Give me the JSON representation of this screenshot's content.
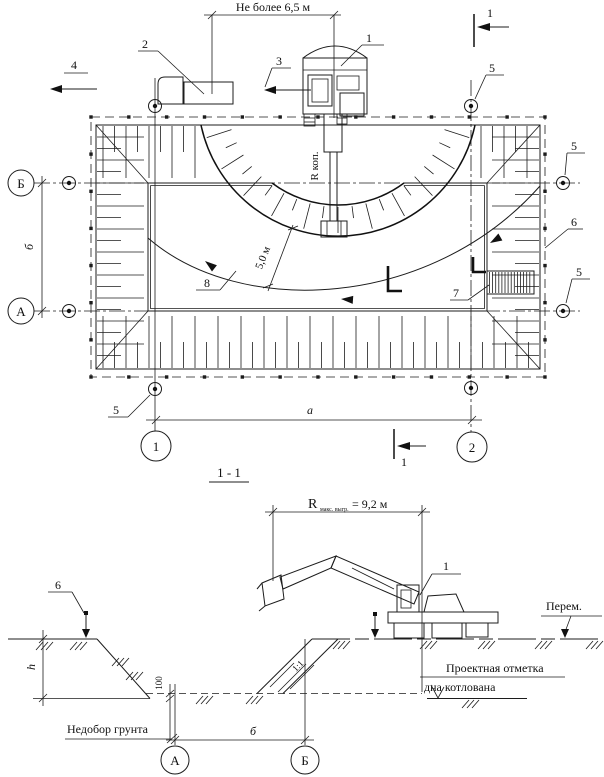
{
  "plan": {
    "top_dim": "Не более 6,5 м",
    "callout_1": "1",
    "callout_2": "2",
    "callout_3": "3",
    "callout_4": "4",
    "callout_5": "5",
    "callout_6": "6",
    "callout_7": "7",
    "callout_8": "8",
    "section_mark": "1",
    "axis_b": "Б",
    "axis_a": "А",
    "axis_1": "1",
    "axis_2": "2",
    "dim_a": "a",
    "dim_b": "б",
    "dig_radius": "R коп.",
    "arc_dim": "5,0 м"
  },
  "section": {
    "title": "1 - 1",
    "r_prefix": "R",
    "r_sub": "макс. выгр.",
    "r_value": "= 9,2 м",
    "callout_1": "1",
    "callout_6": "6",
    "move": "Перем.",
    "design_1": "Проектная отметка",
    "design_2": "дна котлована",
    "undercut": "Недобор грунта",
    "undercut_dim": "100",
    "h": "h",
    "slope": "1:1",
    "dim_b": "б",
    "axis_a": "А",
    "axis_b": "Б"
  },
  "colors": {
    "ink": "#1c1c1c",
    "paper": "#ffffff"
  }
}
